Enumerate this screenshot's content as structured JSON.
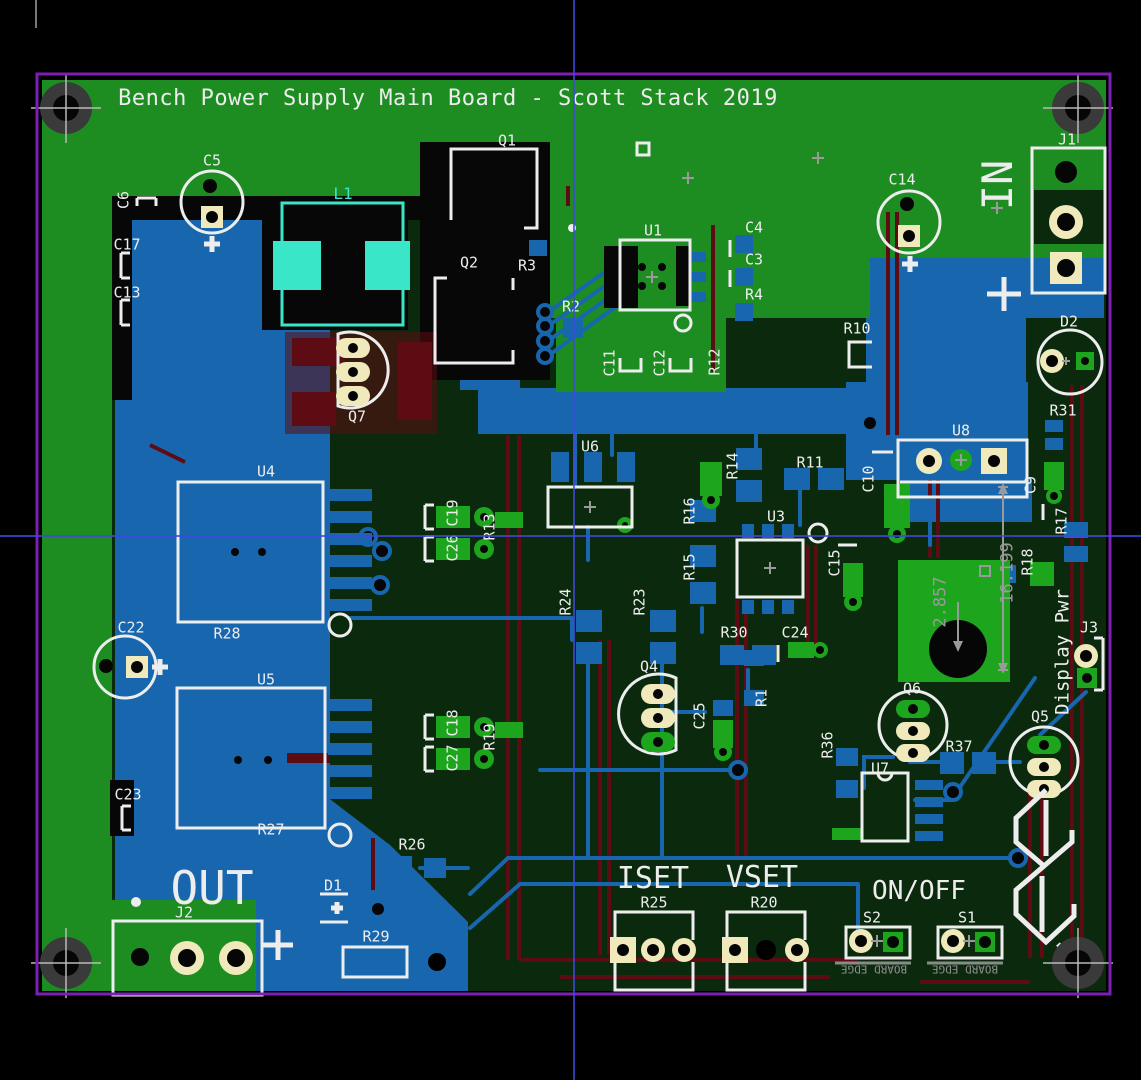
{
  "view": {
    "tool": "pcb-layout-view"
  },
  "colors": {
    "green": "#1d8c21",
    "dark": "#0b2a0d",
    "blue": "#1866ae",
    "red": "#5c0c12",
    "silk": "#ededed",
    "cream": "#efe9bc",
    "padgreen": "#1da51d",
    "cyan": "#39e6c8",
    "purple": "#7d1eb4",
    "dim": "#9a9a9a"
  },
  "crosshair": {
    "x": 573,
    "y": 535
  },
  "labels": [
    {
      "name": "title",
      "text": "Bench Power Supply Main Board - Scott Stack 2019",
      "x": 448,
      "y": 99,
      "rot": 0,
      "size": 22
    },
    {
      "name": "c5",
      "text": "C5",
      "x": 212,
      "y": 161,
      "rot": 0,
      "size": 15
    },
    {
      "name": "c6",
      "text": "C6",
      "x": 124,
      "y": 200,
      "rot": -90,
      "size": 15
    },
    {
      "name": "c17",
      "text": "C17",
      "x": 127,
      "y": 245,
      "rot": 0,
      "size": 15
    },
    {
      "name": "c13",
      "text": "C13",
      "x": 127,
      "y": 293,
      "rot": 0,
      "size": 15
    },
    {
      "name": "l1",
      "text": "L1",
      "x": 343,
      "y": 194,
      "rot": 0,
      "size": 16,
      "color": "cyan"
    },
    {
      "name": "q1",
      "text": "Q1",
      "x": 507,
      "y": 141,
      "rot": 0,
      "size": 15
    },
    {
      "name": "q2",
      "text": "Q2",
      "x": 469,
      "y": 263,
      "rot": 0,
      "size": 15
    },
    {
      "name": "r3",
      "text": "R3",
      "x": 527,
      "y": 266,
      "rot": 0,
      "size": 15
    },
    {
      "name": "r2",
      "text": "R2",
      "x": 571,
      "y": 307,
      "rot": 0,
      "size": 15
    },
    {
      "name": "u1",
      "text": "U1",
      "x": 653,
      "y": 231,
      "rot": 0,
      "size": 15
    },
    {
      "name": "c4",
      "text": "C4",
      "x": 754,
      "y": 228,
      "rot": 0,
      "size": 15
    },
    {
      "name": "c3",
      "text": "C3",
      "x": 754,
      "y": 260,
      "rot": 0,
      "size": 15
    },
    {
      "name": "r4",
      "text": "R4",
      "x": 754,
      "y": 295,
      "rot": 0,
      "size": 15
    },
    {
      "name": "c11",
      "text": "C11",
      "x": 610,
      "y": 363,
      "rot": -90,
      "size": 15
    },
    {
      "name": "c12",
      "text": "C12",
      "x": 660,
      "y": 363,
      "rot": -90,
      "size": 15
    },
    {
      "name": "r12",
      "text": "R12",
      "x": 715,
      "y": 362,
      "rot": -90,
      "size": 15
    },
    {
      "name": "c14",
      "text": "C14",
      "x": 902,
      "y": 180,
      "rot": 0,
      "size": 15
    },
    {
      "name": "in",
      "text": "IN",
      "x": 998,
      "y": 185,
      "rot": -90,
      "size": 42
    },
    {
      "name": "j1",
      "text": "J1",
      "x": 1067,
      "y": 140,
      "rot": 0,
      "size": 15
    },
    {
      "name": "d2",
      "text": "D2",
      "x": 1069,
      "y": 322,
      "rot": 0,
      "size": 15
    },
    {
      "name": "r31",
      "text": "R31",
      "x": 1063,
      "y": 411,
      "rot": 0,
      "size": 15
    },
    {
      "name": "r10",
      "text": "R10",
      "x": 857,
      "y": 329,
      "rot": 0,
      "size": 15
    },
    {
      "name": "q7",
      "text": "Q7",
      "x": 357,
      "y": 417,
      "rot": 0,
      "size": 15
    },
    {
      "name": "u6",
      "text": "U6",
      "x": 590,
      "y": 447,
      "rot": 0,
      "size": 15
    },
    {
      "name": "u8",
      "text": "U8",
      "x": 961,
      "y": 431,
      "rot": 0,
      "size": 15
    },
    {
      "name": "c10",
      "text": "C10",
      "x": 869,
      "y": 479,
      "rot": -90,
      "size": 15
    },
    {
      "name": "c9",
      "text": "C9",
      "x": 1031,
      "y": 485,
      "rot": -90,
      "size": 15
    },
    {
      "name": "r17",
      "text": "R17",
      "x": 1062,
      "y": 521,
      "rot": -90,
      "size": 15
    },
    {
      "name": "r18",
      "text": "R18",
      "x": 1028,
      "y": 562,
      "rot": -90,
      "size": 15
    },
    {
      "name": "r14",
      "text": "R14",
      "x": 733,
      "y": 466,
      "rot": -90,
      "size": 15
    },
    {
      "name": "r11",
      "text": "R11",
      "x": 810,
      "y": 463,
      "rot": 0,
      "size": 15
    },
    {
      "name": "r16",
      "text": "R16",
      "x": 690,
      "y": 511,
      "rot": -90,
      "size": 15
    },
    {
      "name": "r15",
      "text": "R15",
      "x": 690,
      "y": 567,
      "rot": -90,
      "size": 15
    },
    {
      "name": "u3",
      "text": "U3",
      "x": 776,
      "y": 517,
      "rot": 0,
      "size": 15
    },
    {
      "name": "c15",
      "text": "C15",
      "x": 835,
      "y": 563,
      "rot": -90,
      "size": 15
    },
    {
      "name": "u4",
      "text": "U4",
      "x": 266,
      "y": 472,
      "rot": 0,
      "size": 15
    },
    {
      "name": "c19",
      "text": "C19",
      "x": 453,
      "y": 513,
      "rot": -90,
      "size": 15
    },
    {
      "name": "c26",
      "text": "C26",
      "x": 453,
      "y": 548,
      "rot": -90,
      "size": 15
    },
    {
      "name": "r13",
      "text": "R13",
      "x": 490,
      "y": 527,
      "rot": -90,
      "size": 15
    },
    {
      "name": "r24",
      "text": "R24",
      "x": 566,
      "y": 602,
      "rot": -90,
      "size": 15
    },
    {
      "name": "r23",
      "text": "R23",
      "x": 640,
      "y": 602,
      "rot": -90,
      "size": 15
    },
    {
      "name": "r30",
      "text": "R30",
      "x": 734,
      "y": 633,
      "rot": 0,
      "size": 15
    },
    {
      "name": "c24",
      "text": "C24",
      "x": 795,
      "y": 633,
      "rot": 0,
      "size": 15
    },
    {
      "name": "c22",
      "text": "C22",
      "x": 131,
      "y": 628,
      "rot": 0,
      "size": 15
    },
    {
      "name": "r28",
      "text": "R28",
      "x": 227,
      "y": 634,
      "rot": 0,
      "size": 15
    },
    {
      "name": "u5",
      "text": "U5",
      "x": 266,
      "y": 680,
      "rot": 0,
      "size": 15
    },
    {
      "name": "c18",
      "text": "C18",
      "x": 453,
      "y": 723,
      "rot": -90,
      "size": 15
    },
    {
      "name": "c27",
      "text": "C27",
      "x": 453,
      "y": 758,
      "rot": -90,
      "size": 15
    },
    {
      "name": "r19",
      "text": "R19",
      "x": 490,
      "y": 737,
      "rot": -90,
      "size": 15
    },
    {
      "name": "c23",
      "text": "C23",
      "x": 128,
      "y": 795,
      "rot": 0,
      "size": 15
    },
    {
      "name": "r27",
      "text": "R27",
      "x": 271,
      "y": 830,
      "rot": 0,
      "size": 15
    },
    {
      "name": "q4",
      "text": "Q4",
      "x": 649,
      "y": 667,
      "rot": 0,
      "size": 15
    },
    {
      "name": "c25",
      "text": "C25",
      "x": 700,
      "y": 716,
      "rot": -90,
      "size": 15
    },
    {
      "name": "r1",
      "text": "R1",
      "x": 762,
      "y": 698,
      "rot": -90,
      "size": 15
    },
    {
      "name": "q6",
      "text": "Q6",
      "x": 912,
      "y": 689,
      "rot": 0,
      "size": 15
    },
    {
      "name": "r36",
      "text": "R36",
      "x": 828,
      "y": 745,
      "rot": -90,
      "size": 15
    },
    {
      "name": "r37",
      "text": "R37",
      "x": 959,
      "y": 747,
      "rot": 0,
      "size": 15
    },
    {
      "name": "u7",
      "text": "U7",
      "x": 880,
      "y": 769,
      "rot": 0,
      "size": 15
    },
    {
      "name": "q5",
      "text": "Q5",
      "x": 1040,
      "y": 717,
      "rot": 0,
      "size": 15
    },
    {
      "name": "dim-2857",
      "text": "2.857",
      "x": 941,
      "y": 602,
      "rot": -90,
      "size": 17,
      "color": "dim"
    },
    {
      "name": "dim-16199",
      "text": "16.199",
      "x": 1008,
      "y": 573,
      "rot": -90,
      "size": 17,
      "color": "dim"
    },
    {
      "name": "display-pwr",
      "text": "Display Pwr",
      "x": 1063,
      "y": 652,
      "rot": -90,
      "size": 19
    },
    {
      "name": "j3",
      "text": "J3",
      "x": 1089,
      "y": 628,
      "rot": 0,
      "size": 15
    },
    {
      "name": "out",
      "text": "OUT",
      "x": 212,
      "y": 888,
      "rot": 0,
      "size": 46
    },
    {
      "name": "j2",
      "text": "J2",
      "x": 184,
      "y": 913,
      "rot": 0,
      "size": 15
    },
    {
      "name": "d1",
      "text": "D1",
      "x": 333,
      "y": 886,
      "rot": 0,
      "size": 15
    },
    {
      "name": "r29",
      "text": "R29",
      "x": 376,
      "y": 937,
      "rot": 0,
      "size": 15
    },
    {
      "name": "r26",
      "text": "R26",
      "x": 412,
      "y": 845,
      "rot": 0,
      "size": 15
    },
    {
      "name": "iset",
      "text": "ISET",
      "x": 653,
      "y": 879,
      "rot": 0,
      "size": 30
    },
    {
      "name": "r25",
      "text": "R25",
      "x": 654,
      "y": 903,
      "rot": 0,
      "size": 15
    },
    {
      "name": "vset",
      "text": "VSET",
      "x": 762,
      "y": 878,
      "rot": 0,
      "size": 30
    },
    {
      "name": "r20",
      "text": "R20",
      "x": 764,
      "y": 903,
      "rot": 0,
      "size": 15
    },
    {
      "name": "on-off",
      "text": "ON/OFF",
      "x": 919,
      "y": 891,
      "rot": 0,
      "size": 26
    },
    {
      "name": "s2",
      "text": "S2",
      "x": 872,
      "y": 918,
      "rot": 0,
      "size": 15
    },
    {
      "name": "s1",
      "text": "S1",
      "x": 967,
      "y": 918,
      "rot": 0,
      "size": 15
    },
    {
      "name": "board-edge-1",
      "text": "BOARD EDGE",
      "x": 874,
      "y": 969,
      "rot": 180,
      "size": 11,
      "color": "edgecol"
    },
    {
      "name": "board-edge-2",
      "text": "BOARD EDGE",
      "x": 965,
      "y": 969,
      "rot": 180,
      "size": 11,
      "color": "edgecol"
    }
  ]
}
